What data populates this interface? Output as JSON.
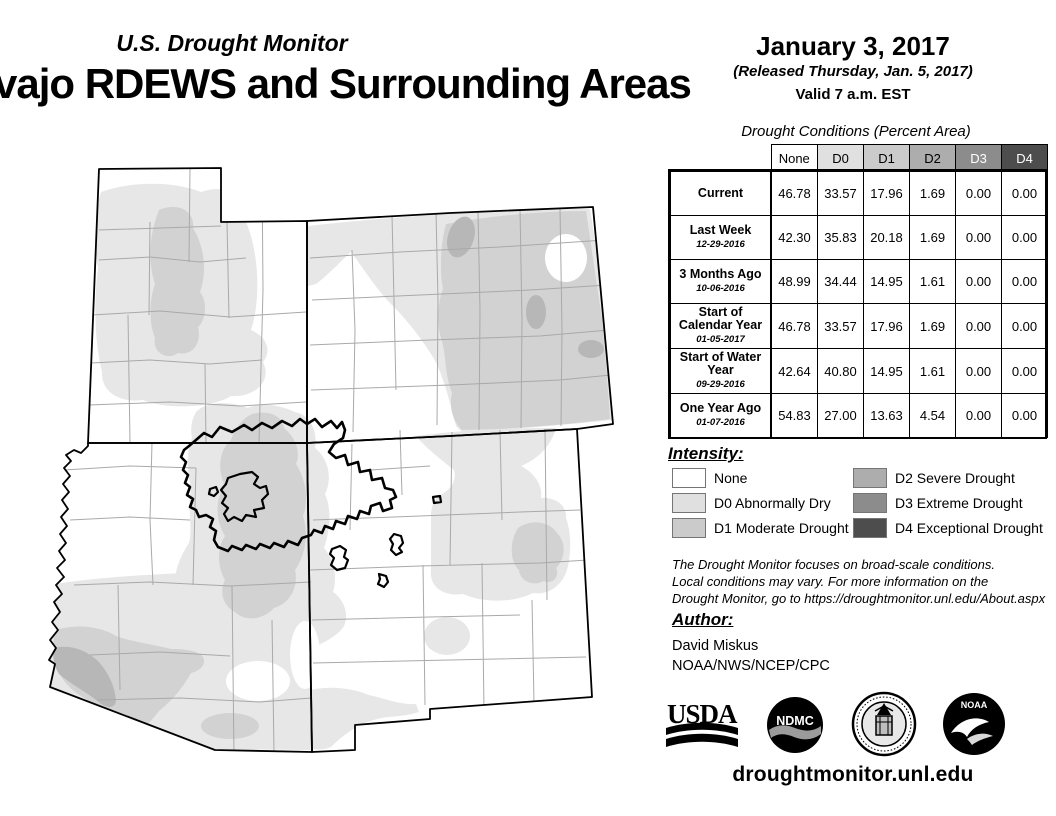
{
  "header": {
    "app_title": "U.S. Drought Monitor",
    "map_title": "vajo RDEWS and Surrounding Areas",
    "date": "January 3, 2017",
    "released": "(Released Thursday, Jan. 5, 2017)",
    "valid": "Valid 7 a.m. EST"
  },
  "conditions_table": {
    "title": "Drought Conditions (Percent Area)",
    "columns": [
      {
        "label": "None",
        "bg": "#ffffff",
        "fg": "#000000"
      },
      {
        "label": "D0",
        "bg": "#e0e0e0",
        "fg": "#000000"
      },
      {
        "label": "D1",
        "bg": "#cbcbcb",
        "fg": "#000000"
      },
      {
        "label": "D2",
        "bg": "#adadad",
        "fg": "#000000"
      },
      {
        "label": "D3",
        "bg": "#8c8c8c",
        "fg": "#ffffff"
      },
      {
        "label": "D4",
        "bg": "#4d4d4d",
        "fg": "#ffffff"
      }
    ],
    "rows": [
      {
        "label": "Current",
        "date": "",
        "values": [
          "46.78",
          "33.57",
          "17.96",
          "1.69",
          "0.00",
          "0.00"
        ]
      },
      {
        "label": "Last Week",
        "date": "12-29-2016",
        "values": [
          "42.30",
          "35.83",
          "20.18",
          "1.69",
          "0.00",
          "0.00"
        ]
      },
      {
        "label": "3 Months Ago",
        "date": "10-06-2016",
        "values": [
          "48.99",
          "34.44",
          "14.95",
          "1.61",
          "0.00",
          "0.00"
        ]
      },
      {
        "label": "Start of Calendar Year",
        "date": "01-05-2017",
        "values": [
          "46.78",
          "33.57",
          "17.96",
          "1.69",
          "0.00",
          "0.00"
        ]
      },
      {
        "label": "Start of Water Year",
        "date": "09-29-2016",
        "values": [
          "42.64",
          "40.80",
          "14.95",
          "1.61",
          "0.00",
          "0.00"
        ]
      },
      {
        "label": "One Year Ago",
        "date": "01-07-2016",
        "values": [
          "54.83",
          "27.00",
          "13.63",
          "4.54",
          "0.00",
          "0.00"
        ]
      }
    ]
  },
  "legend": {
    "title": "Intensity:",
    "items": [
      {
        "code": "none",
        "label": "None",
        "color": "#ffffff"
      },
      {
        "code": "D0",
        "label": "D0 Abnormally Dry",
        "color": "#e0e0e0"
      },
      {
        "code": "D1",
        "label": "D1 Moderate Drought",
        "color": "#cbcbcb"
      },
      {
        "code": "D2",
        "label": "D2 Severe Drought",
        "color": "#adadad"
      },
      {
        "code": "D3",
        "label": "D3 Extreme Drought",
        "color": "#8c8c8c"
      },
      {
        "code": "D4",
        "label": "D4 Exceptional Drought",
        "color": "#4d4d4d"
      }
    ]
  },
  "notes": {
    "line1": "The Drought Monitor focuses on broad-scale conditions.",
    "line2": "Local conditions may vary. For more information on the",
    "line3": "Drought Monitor, go to https://droughtmonitor.unl.edu/About.aspx"
  },
  "author": {
    "heading": "Author:",
    "name": "David Miskus",
    "org": "NOAA/NWS/NCEP/CPC"
  },
  "footer": {
    "url": "droughtmonitor.unl.edu",
    "logos": {
      "usda": "USDA",
      "ndmc": "NDMC",
      "doc": "U.S. Department of Commerce seal",
      "noaa": "NOAA"
    }
  },
  "map": {
    "region": "Four Corners states (Utah, Colorado, Arizona, New Mexico) with Navajo Nation and Hopi boundaries",
    "colors": {
      "none": "#ffffff",
      "d0": "#e7e7e7",
      "d1": "#d2d2d2",
      "d2": "#b7b7b7",
      "d3": "#8c8c8c",
      "d4": "#4d4d4d",
      "county_line": "#a9a9a9",
      "state_line": "#000000",
      "reservation_line": "#000000"
    }
  },
  "chart_data": {
    "type": "table",
    "title": "Drought Conditions (Percent Area)",
    "columns": [
      "None",
      "D0",
      "D1",
      "D2",
      "D3",
      "D4"
    ],
    "rows": [
      [
        "Current",
        46.78,
        33.57,
        17.96,
        1.69,
        0.0,
        0.0
      ],
      [
        "Last Week 12-29-2016",
        42.3,
        35.83,
        20.18,
        1.69,
        0.0,
        0.0
      ],
      [
        "3 Months Ago 10-06-2016",
        48.99,
        34.44,
        14.95,
        1.61,
        0.0,
        0.0
      ],
      [
        "Start of Calendar Year 01-05-2017",
        46.78,
        33.57,
        17.96,
        1.69,
        0.0,
        0.0
      ],
      [
        "Start of Water Year 09-29-2016",
        42.64,
        40.8,
        14.95,
        1.61,
        0.0,
        0.0
      ],
      [
        "One Year Ago 01-07-2016",
        54.83,
        27.0,
        13.63,
        4.54,
        0.0,
        0.0
      ]
    ]
  }
}
